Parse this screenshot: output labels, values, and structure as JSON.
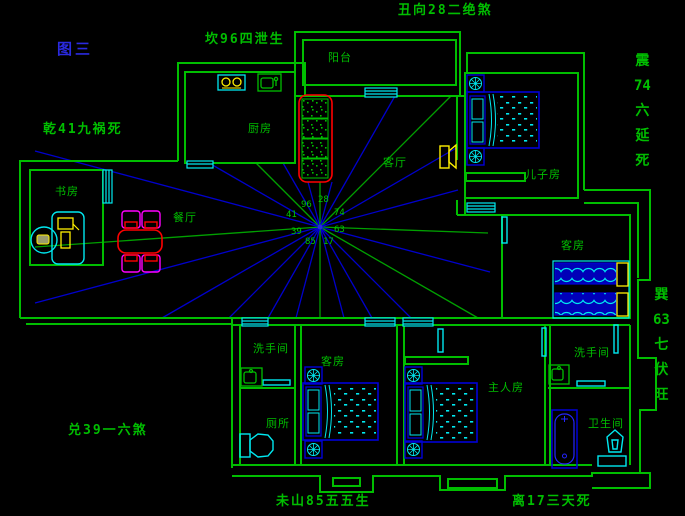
{
  "figure_label": "图三",
  "annotations": {
    "top": "丑向28二绝煞",
    "north": "坎96四泄生",
    "northwest": "乾41九祸死",
    "west": "兑39一六煞",
    "south_left": "未山85五五生",
    "south_right": "离17三天死",
    "east_vertical": [
      "震",
      "74",
      "六",
      "延",
      "死"
    ],
    "southeast_vertical": [
      "巽",
      "63",
      "七",
      "伏",
      "旺"
    ]
  },
  "compass_numbers": {
    "qian": "41",
    "kan": "96",
    "gen": "28",
    "zhen": "74",
    "xun": "63",
    "li": "17",
    "kun": "85",
    "dui": "39"
  },
  "rooms": {
    "balcony": "阳台",
    "kitchen": "厨房",
    "study": "书房",
    "dining": "餐厅",
    "living": "客厅",
    "son_room": "儿子房",
    "guest_room_east": "客房",
    "washroom_west": "洗手间",
    "toilet": "厕所",
    "guest_room_south": "客房",
    "master_room": "主人房",
    "washroom_east": "洗手间",
    "bathroom": "卫生间"
  },
  "colors": {
    "background": "#000000",
    "wall_green": "#00BE00",
    "ray_blue": "#0000CC",
    "ray_green": "#00A000",
    "furniture_blue": "#0000D8",
    "cyan": "#00E8F0",
    "yellow": "#FFF000",
    "red": "#FF0000",
    "magenta": "#FF00FF",
    "title_blue": "#2A2AE0"
  }
}
